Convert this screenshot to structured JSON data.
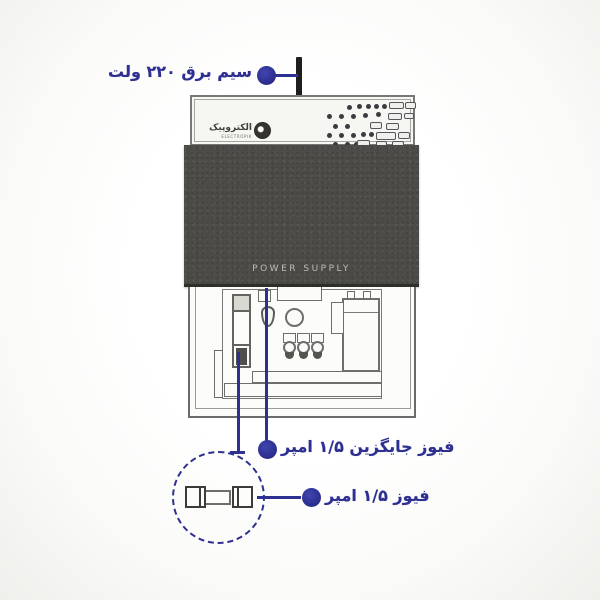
{
  "labels": {
    "power_wire": "سیم برق ۲۲۰ ولت",
    "spare_fuse": "فیوز جایگزین ۱/۵ امپر",
    "fuse": "فیوز ۱/۵ امپر"
  },
  "device": {
    "cover_label": "POWER SUPPLY",
    "brand": {
      "name": "الکتروپیک",
      "subtext": "ELECTROPIK"
    },
    "panel_pattern": {
      "dots": [
        [
          155,
          8
        ],
        [
          165,
          7
        ],
        [
          174,
          7
        ],
        [
          182,
          7
        ],
        [
          190,
          7
        ],
        [
          135,
          17
        ],
        [
          147,
          17
        ],
        [
          159,
          17
        ],
        [
          171,
          16
        ],
        [
          184,
          15
        ],
        [
          141,
          27
        ],
        [
          153,
          27
        ],
        [
          135,
          36
        ],
        [
          147,
          36
        ],
        [
          159,
          36
        ],
        [
          169,
          35
        ],
        [
          177,
          35
        ],
        [
          141,
          45
        ],
        [
          153,
          45
        ],
        [
          162,
          45
        ]
      ],
      "slots": [
        [
          197,
          5,
          15,
          7
        ],
        [
          213,
          5,
          11,
          7
        ],
        [
          196,
          16,
          14,
          7
        ],
        [
          212,
          16,
          10,
          6
        ],
        [
          178,
          25,
          12,
          7
        ],
        [
          194,
          26,
          13,
          7
        ],
        [
          184,
          35,
          20,
          8
        ],
        [
          206,
          35,
          12,
          7
        ],
        [
          165,
          43,
          13,
          7
        ],
        [
          184,
          44,
          11,
          7
        ],
        [
          200,
          44,
          12,
          7
        ]
      ]
    }
  },
  "colors": {
    "accent_navy": "#2d3090",
    "cover_gray": "#4c4b47",
    "outline_gray": "#6b6b6b",
    "cord_black": "#1e1e1e"
  }
}
